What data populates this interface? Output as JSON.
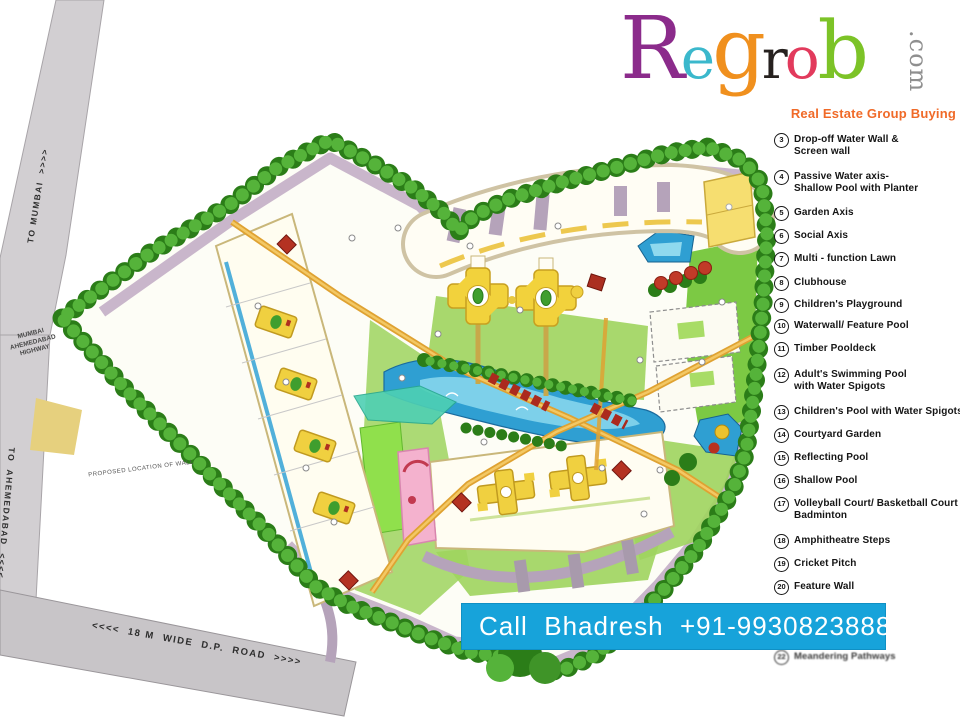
{
  "brand": {
    "name_letters": [
      {
        "char": "R",
        "color": "#8b2b8b"
      },
      {
        "char": "e",
        "color": "#3bb8cc"
      },
      {
        "char": "g",
        "color": "#f0901e"
      },
      {
        "char": "r",
        "color": "#26211f"
      },
      {
        "char": "o",
        "color": "#e23a5c"
      },
      {
        "char": "b",
        "color": "#7cc327"
      }
    ],
    "domain_suffix": ".com",
    "tagline": "Real Estate Group Buying",
    "tagline_color": "#f06a28"
  },
  "legend": {
    "items": [
      {
        "num": "3",
        "label": "Drop-off Water Wall &\nScreen wall"
      },
      {
        "num": "4",
        "label": "Passive Water axis-\nShallow Pool with Planter"
      },
      {
        "num": "5",
        "label": "Garden Axis"
      },
      {
        "num": "6",
        "label": "Social Axis"
      },
      {
        "num": "7",
        "label": "Multi - function Lawn"
      },
      {
        "num": "8",
        "label": "Clubhouse"
      },
      {
        "num": "9",
        "label": "Children's Playground"
      },
      {
        "num": "10",
        "label": "Waterwall/ Feature Pool"
      },
      {
        "num": "11",
        "label": "Timber Pooldeck"
      },
      {
        "num": "12",
        "label": "Adult's Swimming Pool\nwith Water Spigots"
      },
      {
        "num": "13",
        "label": "Children's Pool with Water Spigots"
      },
      {
        "num": "14",
        "label": "Courtyard Garden"
      },
      {
        "num": "15",
        "label": "Reflecting Pool"
      },
      {
        "num": "16",
        "label": "Shallow Pool"
      },
      {
        "num": "17",
        "label": "Volleyball Court/ Basketball Court /\nBadminton"
      },
      {
        "num": "18",
        "label": "Amphitheatre Steps"
      },
      {
        "num": "19",
        "label": "Cricket Pitch"
      },
      {
        "num": "20",
        "label": "Feature Wall"
      },
      {
        "num": "22",
        "label": "Meandering Pathways"
      }
    ]
  },
  "contact_banner": {
    "text": "Call  Bhadresh  +91-9930823888",
    "bg_color": "#17a3da",
    "text_color": "#ffffff"
  },
  "map_labels": {
    "to_mumbai": "TO MUMBAI  >>>>",
    "highway_name": "MUMBAI\nAHEMEDABAD\nHIGHWAY",
    "to_ahemedabad": "TO  AHEMEDABAD  <<<<",
    "proposed_wall": "PROPOSED LOCATION OF WALL",
    "dp_road": "<<<<  18 M  WIDE  D.P.  ROAD  >>>>"
  },
  "site_plan_colors": {
    "tree_dark": "#2b7d18",
    "tree_light": "#55b33a",
    "road_grey": "#d2cfd2",
    "internal_road_mauve": "#c6b2c8",
    "water_blue": "#2f9fd2",
    "lawn_green": "#9ed45e",
    "path_orange": "#dfa232",
    "tower_yellow": "#f0d040",
    "pavilion_red": "#b43222",
    "playground_pink": "#f4b2ce"
  }
}
